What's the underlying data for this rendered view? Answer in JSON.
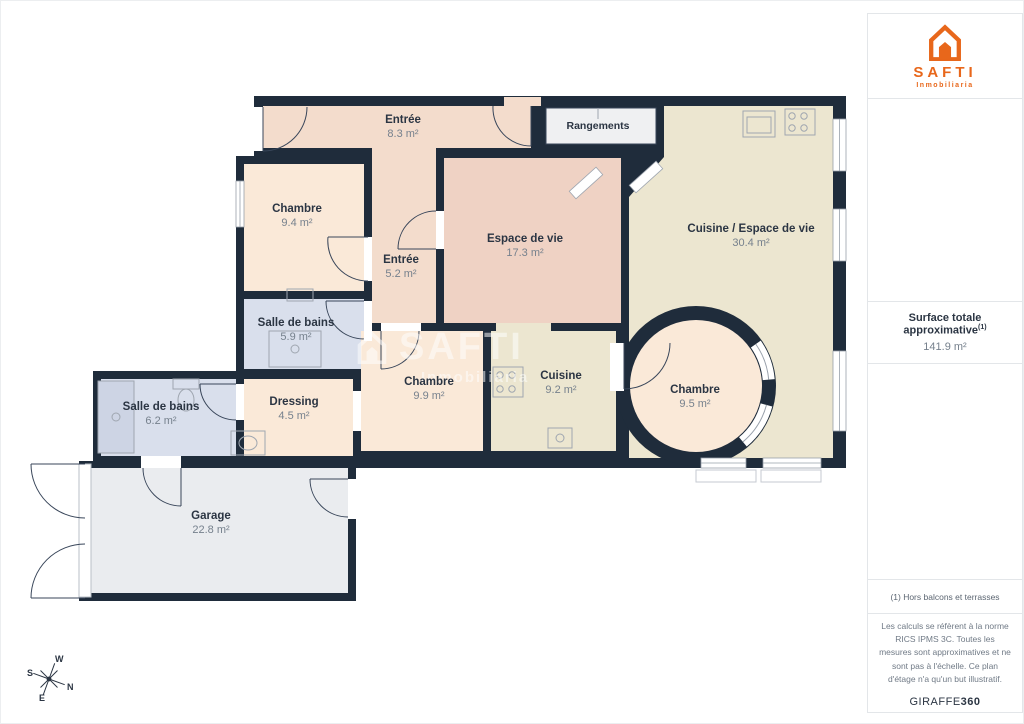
{
  "branding": {
    "logo_text": "SAFTI",
    "logo_subtext": "Inmobiliaria",
    "brand_color": "#E8671B",
    "watermark_text": "SAFTI",
    "watermark_subtext": "Inmobiliaria"
  },
  "sidebar": {
    "surface_title": "Surface totale approximative",
    "surface_sup": "(1)",
    "surface_value": "141.9 m²",
    "footnote": "(1) Hors balcons et terrasses",
    "legal": "Les calculs se réfèrent à la norme RICS IPMS 3C. Toutes les mesures sont approximatives et ne sont pas à l'échelle. Ce plan d'étage n'a qu'un but illustratif.",
    "credit_brand": "GIRAFFE",
    "credit_suffix": "360"
  },
  "compass": {
    "n": "N",
    "s": "S",
    "e": "E",
    "w": "W"
  },
  "rooms": [
    {
      "name": "Entrée",
      "area": "8.3 m²"
    },
    {
      "name": "Rangements",
      "area": ""
    },
    {
      "name": "Chambre",
      "area": "9.4 m²"
    },
    {
      "name": "Entrée",
      "area": "5.2 m²"
    },
    {
      "name": "Espace de vie",
      "area": "17.3 m²"
    },
    {
      "name": "Cuisine / Espace de vie",
      "area": "30.4 m²"
    },
    {
      "name": "Salle de bains",
      "area": "5.9 m²"
    },
    {
      "name": "Chambre",
      "area": "9.9 m²"
    },
    {
      "name": "Cuisine",
      "area": "9.2 m²"
    },
    {
      "name": "Chambre",
      "area": "9.5 m²"
    },
    {
      "name": "Salle de bains",
      "area": "6.2 m²"
    },
    {
      "name": "Dressing",
      "area": "4.5 m²"
    },
    {
      "name": "Garage",
      "area": "22.8 m²"
    }
  ],
  "colors": {
    "wall": "#1F2C3B",
    "floor_pink_light": "#F3DCCC",
    "floor_pink": "#EFD2C4",
    "floor_cream": "#FAE9D8",
    "floor_beige": "#ECE6D0",
    "floor_lavender": "#D9DFEC",
    "floor_gray": "#EAECEF",
    "label_dark": "#2B3543",
    "label_gray": "#76818D"
  }
}
